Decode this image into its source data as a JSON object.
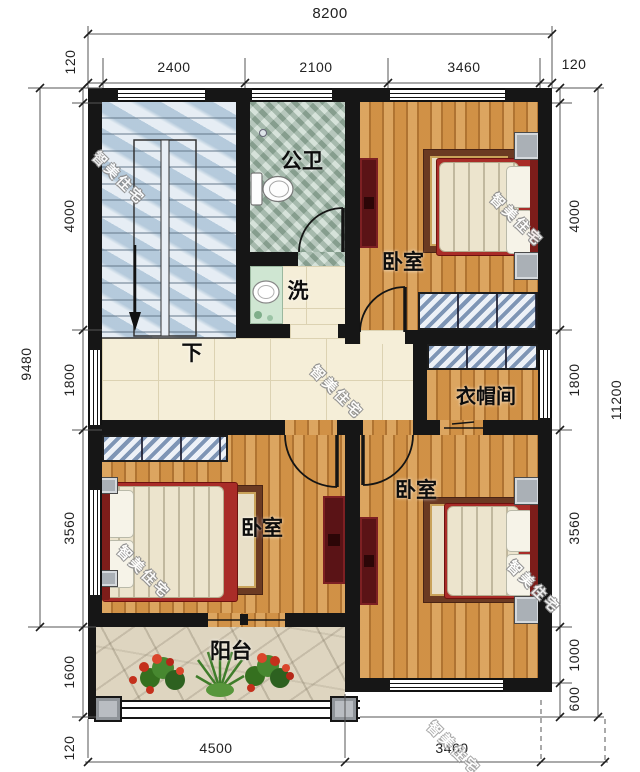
{
  "watermark": {
    "text": "智美住宅"
  },
  "rooms": {
    "bathroom": "公卫",
    "wash": "洗",
    "stair_down": "下",
    "bedroom": "卧室",
    "cloakroom": "衣帽间",
    "balcony": "阳台"
  },
  "dims": {
    "top_overall": "8200",
    "top": [
      "120",
      "2400",
      "2100",
      "3460",
      "120"
    ],
    "left_overall": "9480",
    "left": [
      "4000",
      "1800",
      "3560",
      "1600"
    ],
    "right_overall": "11200",
    "right": [
      "4000",
      "1800",
      "3560",
      "1000",
      "600"
    ],
    "bottom": [
      "120",
      "4500",
      "3460"
    ]
  },
  "colors": {
    "wall": "#161616",
    "wood_floor": "#c9883e",
    "hall_tile": "#f5eed8",
    "stair_marble": "#c7d8e6",
    "bath_tile": "#a9c0b1",
    "balcony_stone": "#ded5c0",
    "bed_red": "#a92c28",
    "cabinet_maroon": "#5a1316",
    "wardrobe_blue": "#7e95b5"
  }
}
